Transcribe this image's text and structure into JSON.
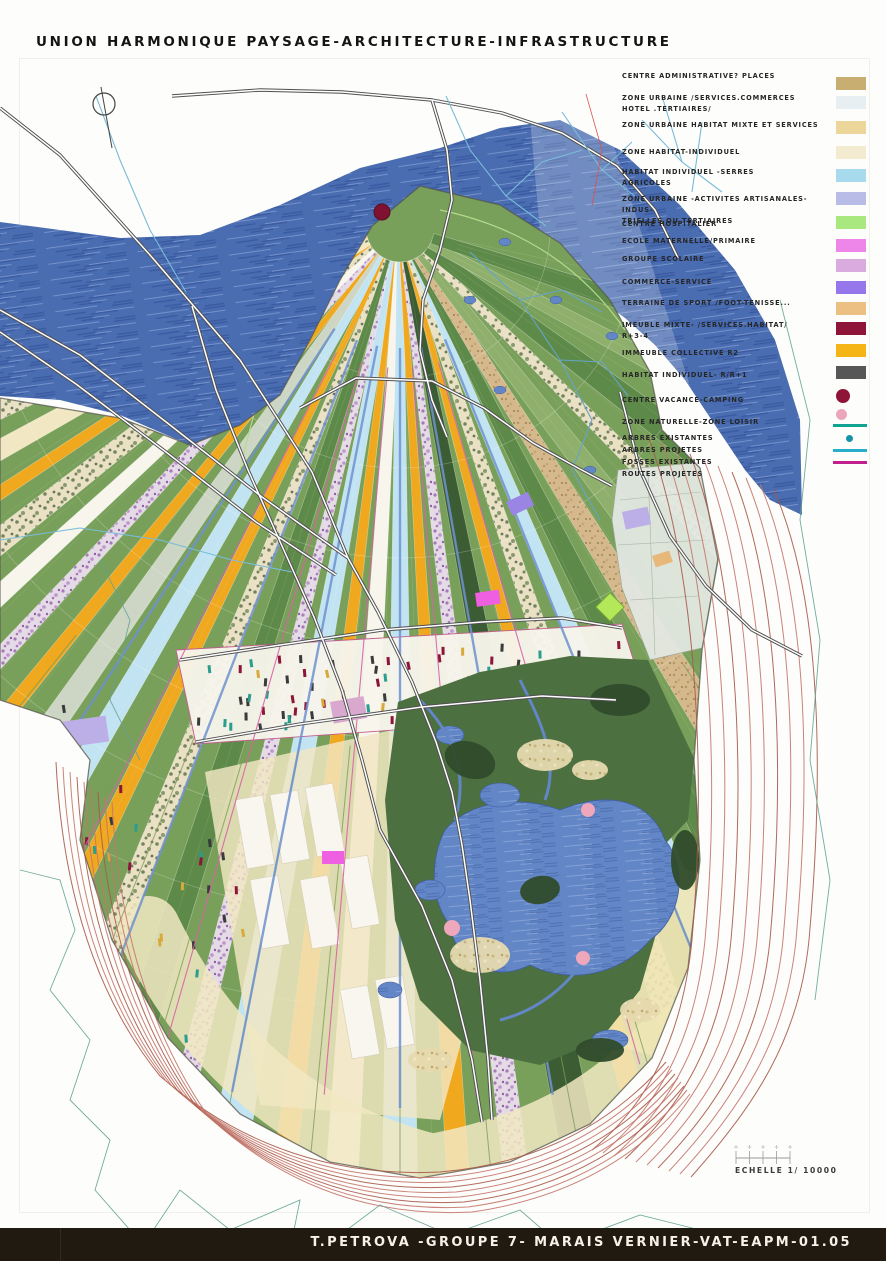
{
  "title": "UNION HARMONIQUE PAYSAGE-ARCHITECTURE-INFRASTRUCTURE",
  "scale": {
    "label": "ECHELLE 1/ 10000"
  },
  "footer": {
    "text": "T.PETROVA -GROUPE 7- MARAIS VERNIER-VAT-EAPM-01.05"
  },
  "legend": {
    "items": [
      {
        "label": "CENTRE ADMINISTRATIVE? PLACES",
        "symbol": "rect",
        "color": "#c9ae72"
      },
      {
        "label": "ZONE URBAINE /SERVICES.COMMERCES\nHOTEL .TERTIAIRES/",
        "symbol": "rect",
        "color": "#e7eff2"
      },
      {
        "label": "ZONE URBAINE HABITAT MIXTE ET SERVICES",
        "symbol": "rect",
        "color": "#ecd69a"
      },
      {
        "label": "ZONE HABITAT-INDIVIDUEL",
        "symbol": "rect",
        "color": "#f2ebcf"
      },
      {
        "label": "HABITAT INDIVIDUEL -SERRES\nAGRICOLES",
        "symbol": "rect",
        "color": "#a8daee"
      },
      {
        "label": "ZONE URBAINE -ACTIVITES ARTISANALES-INDUS-\nTRIELLES OU TERTIAIRES",
        "symbol": "rect",
        "color": "#b9bce7"
      },
      {
        "label": "CENTRE HOSPITALIER",
        "symbol": "rect",
        "color": "#a9e87e"
      },
      {
        "label": "ECOLE MATERNELLE/PRIMAIRE",
        "symbol": "rect",
        "color": "#ee86ea"
      },
      {
        "label": "GROUPE SCOLAIRE",
        "symbol": "rect",
        "color": "#d9abdf"
      },
      {
        "label": "COMMERCE-SERVICE",
        "symbol": "rect",
        "color": "#9577eb"
      },
      {
        "label": "TERRAINE DE SPORT /FOOT-TENISSE...",
        "symbol": "rect",
        "color": "#ecc083"
      },
      {
        "label": "IMEUBLE MIXTE- /SERVICES.HABITAT/\nR+3-4",
        "symbol": "rect",
        "color": "#8e1537"
      },
      {
        "label": "IMMEUBLE COLLECTIVE R2",
        "symbol": "rect",
        "color": "#f5b517"
      },
      {
        "label": "HABITAT INDIVIDUEL- R/R+1",
        "symbol": "rect",
        "color": "#575757"
      },
      {
        "label": "CENTRE VACANCE-CAMPING",
        "symbol": "circle",
        "color": "#8e1537"
      },
      {
        "label": "ZONE NATURELLE-ZONE LOISIR",
        "symbol": "circle-small",
        "color": "#eba5bc"
      },
      {
        "label": "ARBRES EXISTANTES",
        "symbol": "line",
        "color": "#10a391"
      },
      {
        "label": "ARBRES PROJETES",
        "symbol": "dot",
        "color": "#1593a9"
      },
      {
        "label": "FOSSES EXISTANTES",
        "symbol": "line",
        "color": "#28aecb"
      },
      {
        "label": "ROUTES PROJETES",
        "symbol": "line",
        "color": "#c2208e"
      }
    ]
  },
  "map": {
    "region_name": "Marais Vernier",
    "colors": {
      "water": "#4a6cb0",
      "water_dark": "#33539b",
      "water_light": "#7e9bd2",
      "land": "#79a05a",
      "land_dark": "#5e8a49",
      "land_light": "#8fb06c",
      "orange": "#f0a81e",
      "lightblue": "#c2e4f2",
      "cream": "#f1e7c2",
      "white_field": "#f7f5ec",
      "gray_green": "#cdd6c4",
      "dark_green": "#3c5c33",
      "tree_base": "#eae0c4",
      "tree_dot": "#74845e",
      "flower_base": "#e4dbe7",
      "flower_dot": "#a878b8",
      "tan_base": "#d5b88c",
      "tan_dot": "#b2955f",
      "marsh": "#4d7040",
      "marsh_water": "#6286c6",
      "reed": "#e6d9ae",
      "wood": "#2f4b2b",
      "contour_red": "#c4766a",
      "contour_red_dark": "#a85948",
      "contour_teal": "#63a394",
      "road_casing": "#4f4f4f",
      "road_fill": "#ffffff",
      "stream": "#79bcd8",
      "canal": "#6f92cf",
      "canal_pink": "#d863a8",
      "marker_maroon": "#7e1230",
      "marker_pink": "#eea7bb",
      "marker_magenta": "#ee5fe2",
      "marker_purple": "#9a84e4",
      "marker_lavender": "#bcaee6",
      "marker_green": "#b3e858",
      "marker_plum": "#d9a8cf",
      "dash_maroon": "#8c1538",
      "dash_gold": "#d8a93c",
      "dash_teal": "#2a9d8f",
      "dash_dark": "#3a3a3a"
    }
  }
}
